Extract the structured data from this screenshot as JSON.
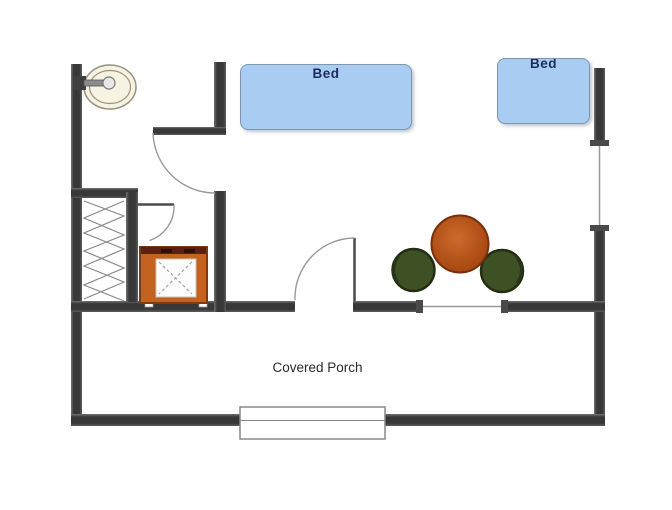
{
  "floorplan": {
    "labels": {
      "bed_1": "Bed",
      "bed_2": "Bed",
      "porch": "Covered Porch"
    },
    "colors": {
      "wall": "#3F3F3F",
      "bed_fill": "#A9CDF2",
      "bed_border": "#8096AD",
      "bed_label_text": "#1C2C60",
      "shower_frame": "#C4621F",
      "shower_top_bar": "#5A2110",
      "table": "#B35018",
      "chair": "#3D5125",
      "sink": "#F6F3E2",
      "door_arc": "#999999",
      "porch_text": "#2A2A2A"
    },
    "fixtures": [
      {
        "name": "bed-1",
        "label": "Bed"
      },
      {
        "name": "bed-2",
        "label": "Bed"
      },
      {
        "name": "bathroom-sink"
      },
      {
        "name": "shower-unit"
      },
      {
        "name": "closet-zigzag"
      },
      {
        "name": "round-table"
      },
      {
        "name": "chair-left"
      },
      {
        "name": "chair-right"
      },
      {
        "name": "bathroom-door-arc"
      },
      {
        "name": "closet-door"
      },
      {
        "name": "entry-door"
      },
      {
        "name": "window-right-wall"
      },
      {
        "name": "window-porch-wall"
      },
      {
        "name": "porch-step"
      },
      {
        "name": "covered-porch",
        "label": "Covered Porch"
      }
    ]
  }
}
